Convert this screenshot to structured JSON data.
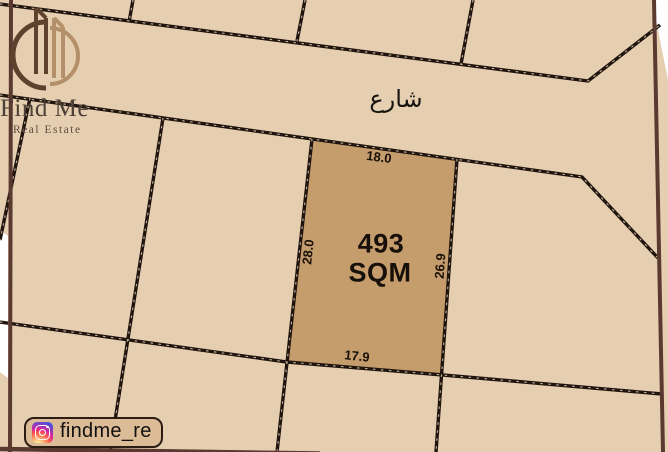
{
  "branding": {
    "title": "Find Me",
    "subtitle": "Real Estate"
  },
  "map": {
    "street_label": "شارع",
    "plot": {
      "area": "493",
      "area_unit": "SQM",
      "dimensions": {
        "top": "18.0",
        "left": "28.0",
        "right": "26.9",
        "bottom": "17.9"
      }
    }
  },
  "social": {
    "instagram_handle": "findme_re"
  },
  "colors": {
    "background": "#e6cfb0",
    "plot_fill": "#c59c6c",
    "boundary_line": "#20150e",
    "map_border": "#5a3a30",
    "badge_bg": "#dcbc97"
  }
}
